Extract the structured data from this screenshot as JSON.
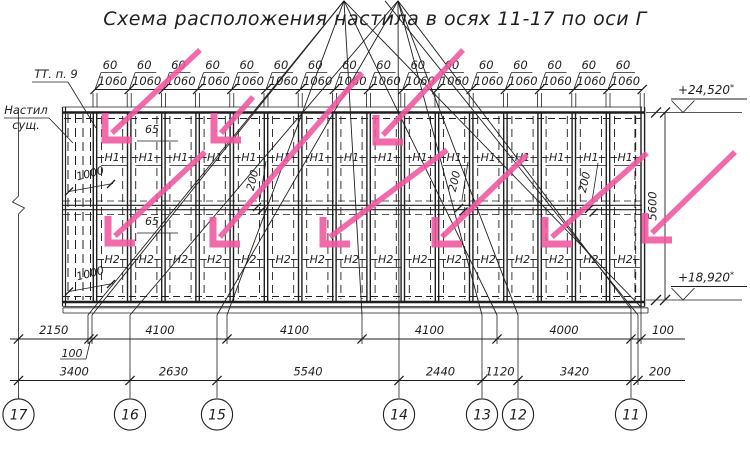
{
  "title": "Схема расположения настила в осях 11-17 по оси Г",
  "colors": {
    "ink": "#1f1f1f",
    "pink": "#f0569f",
    "bg": "#ffffff"
  },
  "top_dims": {
    "gap_label": "60",
    "panel_label": "1060",
    "count": 16
  },
  "panel_labels": {
    "h1": "Н1",
    "h2": "Н2",
    "count": 16
  },
  "side_labels": {
    "tt": "ТТ. п. 9",
    "nastil_line1": "Настил",
    "nastil_line2": "сущ."
  },
  "inner_dims": {
    "d1000": "1000",
    "d65": "65",
    "d200": "200"
  },
  "right_dims": {
    "height": "5600",
    "elev_top": "+24,520",
    "elev_bot": "+18,920",
    "elev_mark": "*"
  },
  "dims_row1": {
    "segs": [
      [
        "2150",
        18.5,
        89,
        ""
      ],
      [
        "100",
        89,
        93,
        "sub"
      ],
      [
        "4100",
        93,
        227,
        ""
      ],
      [
        "4100",
        227,
        362,
        ""
      ],
      [
        "4100",
        362,
        497,
        ""
      ],
      [
        "4000",
        497,
        631,
        ""
      ],
      [
        "100",
        631,
        641,
        "out"
      ]
    ]
  },
  "dims_row2": {
    "segs": [
      [
        "3400",
        18.5,
        130,
        ""
      ],
      [
        "2630",
        130,
        217,
        ""
      ],
      [
        "5540",
        217,
        399,
        ""
      ],
      [
        "2440",
        399,
        482,
        ""
      ],
      [
        "1120",
        482,
        518,
        ""
      ],
      [
        "3420",
        518,
        631,
        ""
      ],
      [
        "200",
        631,
        638,
        "out"
      ]
    ]
  },
  "axes": [
    [
      "17",
      18.5
    ],
    [
      "16",
      130
    ],
    [
      "15",
      217
    ],
    [
      "14",
      399
    ],
    [
      "13",
      482
    ],
    [
      "12",
      518
    ],
    [
      "11",
      631
    ]
  ],
  "arrows": [
    [
      200,
      50,
      105,
      140
    ],
    [
      253,
      97,
      214,
      140
    ],
    [
      463,
      50,
      376,
      142
    ],
    [
      205,
      152,
      108,
      243
    ],
    [
      362,
      73,
      213,
      244
    ],
    [
      447,
      150,
      323,
      244
    ],
    [
      527,
      155,
      435,
      244
    ],
    [
      647,
      153,
      545,
      244
    ],
    [
      735,
      152,
      645,
      240
    ]
  ],
  "d200_positions": [
    [
      256,
      181
    ],
    [
      458,
      182
    ],
    [
      588,
      183
    ]
  ],
  "d1000_positions": [
    [
      91,
      177
    ],
    [
      91,
      277
    ]
  ],
  "d65_positions": [
    [
      152,
      133
    ],
    [
      152,
      225
    ]
  ]
}
